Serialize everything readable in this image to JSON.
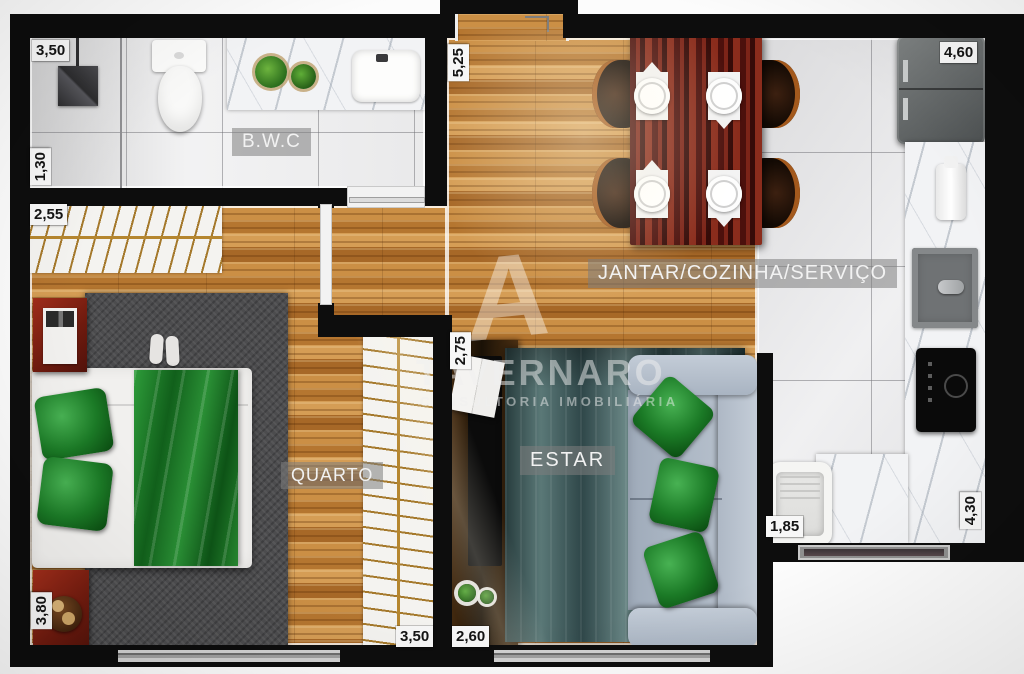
{
  "watermark": {
    "logo": "A",
    "brand": "TAVERNARO",
    "tagline": "CONSULTORIA  IMOBILIÁRIA"
  },
  "rooms": {
    "bathroom": "B.W.C",
    "dining_kitchen_service": "JANTAR/COZINHA/SERVIÇO",
    "bedroom": "QUARTO",
    "living": "ESTAR"
  },
  "dimensions": {
    "bath_width": "3,50",
    "bath_depth": "1,30",
    "closet_width": "2,55",
    "entry_depth": "5,25",
    "kitchen_width": "4,60",
    "hall_depth": "2,75",
    "laundry_width": "1,85",
    "kitchen_depth": "4,30",
    "bedroom_depth": "3,80",
    "bedroom_width": "3,50",
    "living_width": "2,60"
  },
  "colors": {
    "wall": "#0d0d0d",
    "wood_floor": "#bf8038",
    "tile_floor": "#ebebed",
    "marble": "#f2f3f5",
    "accent_green": "#1f7a2b",
    "rug_teal": "#3d5456",
    "rug_gray": "#4c4c4e",
    "sofa": "#b3bdc9",
    "dining_table": "#611710",
    "nightstand_red": "#8c2014",
    "room_badge": "rgba(125,125,125,0.55)"
  }
}
